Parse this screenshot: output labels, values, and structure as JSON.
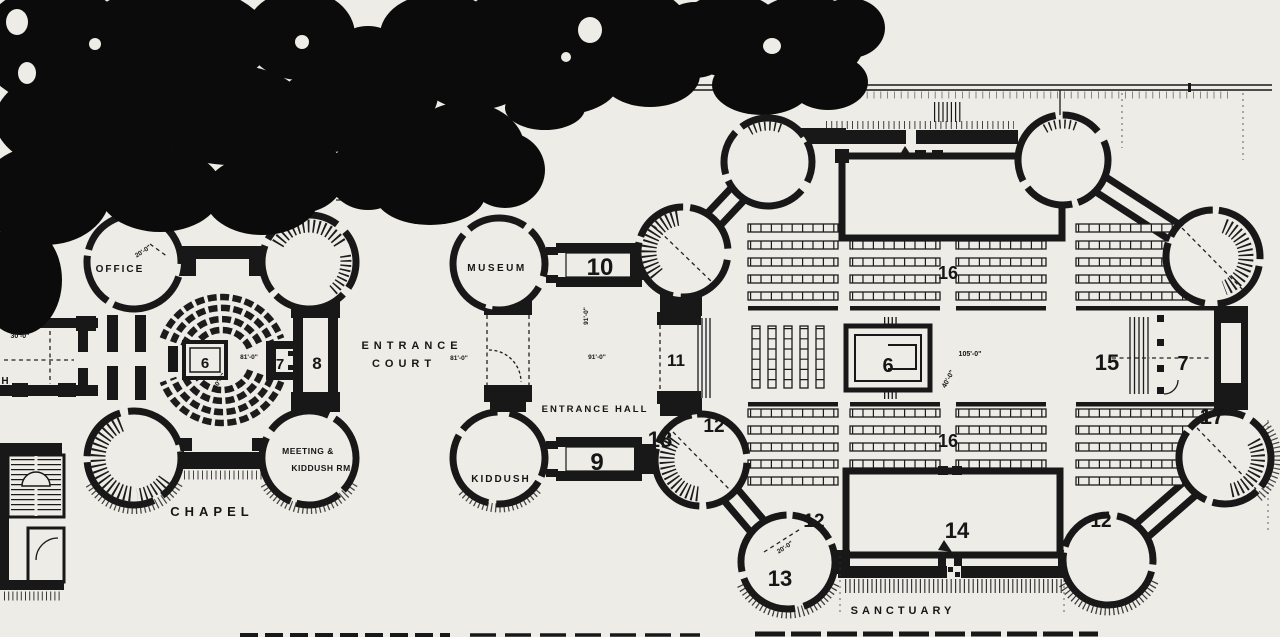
{
  "figure": {
    "kind": "scanned architectural floor plan",
    "colors": {
      "paper": "#edece6",
      "ink": "#181818",
      "trees": "#0b0b0b"
    },
    "labels": [
      {
        "id": "dim-annex",
        "text": "30'-0\"",
        "x": 20,
        "y": 338,
        "size": 7
      },
      {
        "id": "annex-cut-label",
        "text": "H",
        "x": 5,
        "y": 384,
        "size": 10
      },
      {
        "id": "office",
        "text": "OFFICE",
        "x": 120,
        "y": 272,
        "size": 10,
        "ls": 2
      },
      {
        "id": "dim-office",
        "text": "20'-0\"",
        "x": 144,
        "y": 253,
        "size": 6.5,
        "rot": -33
      },
      {
        "id": "chapel",
        "text": "CHAPEL",
        "x": 212,
        "y": 516,
        "size": 13,
        "ls": 5
      },
      {
        "id": "meeting-line1",
        "text": "MEETING &",
        "x": 308,
        "y": 454,
        "size": 8.5,
        "ls": 0.5
      },
      {
        "id": "meeting-line2",
        "text": "KIDDUSH RM",
        "x": 321,
        "y": 471,
        "size": 8.5,
        "ls": 0.5
      },
      {
        "id": "num-6-chapel",
        "text": "6",
        "x": 205,
        "y": 368,
        "size": 15
      },
      {
        "id": "dim-chapel-w",
        "text": "81'-0\"",
        "x": 249,
        "y": 359,
        "size": 6.5
      },
      {
        "id": "dim-chapel-h",
        "text": "40'-0\"",
        "x": 221,
        "y": 382,
        "size": 6.5,
        "rot": -57
      },
      {
        "id": "num-7-chapel",
        "text": "7",
        "x": 280,
        "y": 369,
        "size": 15
      },
      {
        "id": "num-8-chapel",
        "text": "8",
        "x": 317,
        "y": 369,
        "size": 17
      },
      {
        "id": "entrance",
        "text": "ENTRANCE",
        "x": 412,
        "y": 349,
        "size": 11,
        "ls": 5
      },
      {
        "id": "court",
        "text": "COURT",
        "x": 404,
        "y": 367,
        "size": 11,
        "ls": 5
      },
      {
        "id": "dim-court",
        "text": "81'-0\"",
        "x": 459,
        "y": 360,
        "size": 6.5
      },
      {
        "id": "museum",
        "text": "MUSEUM",
        "x": 497,
        "y": 271,
        "size": 10,
        "ls": 2.5
      },
      {
        "id": "num-10",
        "text": "10",
        "x": 600,
        "y": 275,
        "size": 24
      },
      {
        "id": "dim-hall-v",
        "text": "91'-0\"",
        "x": 588,
        "y": 316,
        "size": 6.5,
        "rot": -90
      },
      {
        "id": "dim-hall-h",
        "text": "91'-0\"",
        "x": 597,
        "y": 359,
        "size": 6.5
      },
      {
        "id": "entrance-hall",
        "text": "ENTRANCE HALL",
        "x": 595,
        "y": 412,
        "size": 9.5,
        "ls": 2
      },
      {
        "id": "kiddush",
        "text": "KIDDUSH",
        "x": 501,
        "y": 482,
        "size": 10,
        "ls": 2
      },
      {
        "id": "num-9",
        "text": "9",
        "x": 597,
        "y": 470,
        "size": 24
      },
      {
        "id": "num-18",
        "text": "18",
        "x": 660,
        "y": 447,
        "size": 22
      },
      {
        "id": "num-11",
        "text": "11",
        "x": 676,
        "y": 366,
        "size": 17
      },
      {
        "id": "num-12-mid",
        "text": "12",
        "x": 714,
        "y": 432,
        "size": 19
      },
      {
        "id": "num-16-top",
        "text": "16",
        "x": 948,
        "y": 279,
        "size": 18
      },
      {
        "id": "num-6-sanctuary",
        "text": "6",
        "x": 888,
        "y": 372,
        "size": 20
      },
      {
        "id": "dim-sanctuary-w",
        "text": "105'-0\"",
        "x": 970,
        "y": 356,
        "size": 7
      },
      {
        "id": "dim-sanctuary-h",
        "text": "40'-0\"",
        "x": 950,
        "y": 380,
        "size": 7,
        "rot": -62
      },
      {
        "id": "num-15",
        "text": "15",
        "x": 1107,
        "y": 370,
        "size": 22
      },
      {
        "id": "num-7-sanctuary",
        "text": "7",
        "x": 1183,
        "y": 370,
        "size": 20
      },
      {
        "id": "num-17",
        "text": "17",
        "x": 1212,
        "y": 424,
        "size": 22
      },
      {
        "id": "num-16-bottom",
        "text": "16",
        "x": 948,
        "y": 447,
        "size": 18
      },
      {
        "id": "num-12-bl",
        "text": "12",
        "x": 814,
        "y": 527,
        "size": 19
      },
      {
        "id": "num-13",
        "text": "13",
        "x": 780,
        "y": 586,
        "size": 22
      },
      {
        "id": "dim-tower13",
        "text": "20'-0\"",
        "x": 786,
        "y": 549,
        "size": 6.5,
        "rot": -33
      },
      {
        "id": "num-14",
        "text": "14",
        "x": 957,
        "y": 538,
        "size": 22
      },
      {
        "id": "num-12-br",
        "text": "12",
        "x": 1101,
        "y": 527,
        "size": 19
      },
      {
        "id": "sanctuary",
        "text": "SANCTUARY",
        "x": 903,
        "y": 614,
        "size": 11,
        "ls": 4
      }
    ]
  }
}
